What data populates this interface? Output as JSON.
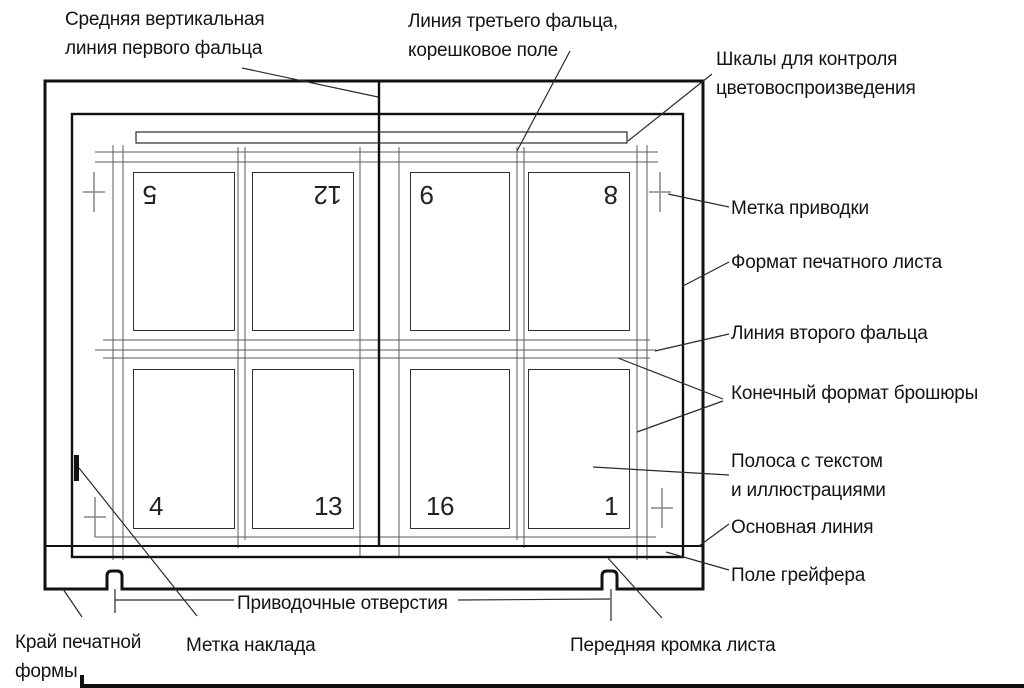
{
  "colors": {
    "ink": "#1a1a1a",
    "thin_line": "#5a5a5a",
    "cross_mark": "#858585",
    "background": "#ffffff"
  },
  "labels": {
    "middle_vertical_first_fold": {
      "line1": "Средняя вертикальная",
      "line2": "линия первого фальца"
    },
    "third_fold_spine_field": {
      "line1": "Линия третьего фальца,",
      "line2": "корешковое поле"
    },
    "color_control_scales": {
      "line1": "Шкалы для контроля",
      "line2": "цветовоспроизведения"
    },
    "register_mark": "Метка приводки",
    "printed_sheet_format": "Формат печатного листа",
    "second_fold_line": "Линия второго фальца",
    "final_booklet_format": "Конечный формат брошюры",
    "text_illustration_strip": {
      "line1": "Полоса с текстом",
      "line2": "и иллюстрациями"
    },
    "base_line": "Основная линия",
    "gripper_field": "Поле грейфера",
    "register_holes": "Приводочные отверстия",
    "printing_form_edge": {
      "line1": "Край печатной",
      "line2": "формы"
    },
    "lay_mark": "Метка наклада",
    "sheet_front_edge": "Передняя кромка листа"
  },
  "pages": [
    {
      "number": "5",
      "rotated": true,
      "corner": "top-left"
    },
    {
      "number": "12",
      "rotated": true,
      "corner": "top-right"
    },
    {
      "number": "9",
      "rotated": true,
      "corner": "top-left"
    },
    {
      "number": "8",
      "rotated": true,
      "corner": "top-right"
    },
    {
      "number": "4",
      "rotated": false,
      "corner": "bottom-left"
    },
    {
      "number": "13",
      "rotated": false,
      "corner": "bottom-right"
    },
    {
      "number": "16",
      "rotated": false,
      "corner": "bottom-left"
    },
    {
      "number": "1",
      "rotated": false,
      "corner": "bottom-right"
    }
  ]
}
